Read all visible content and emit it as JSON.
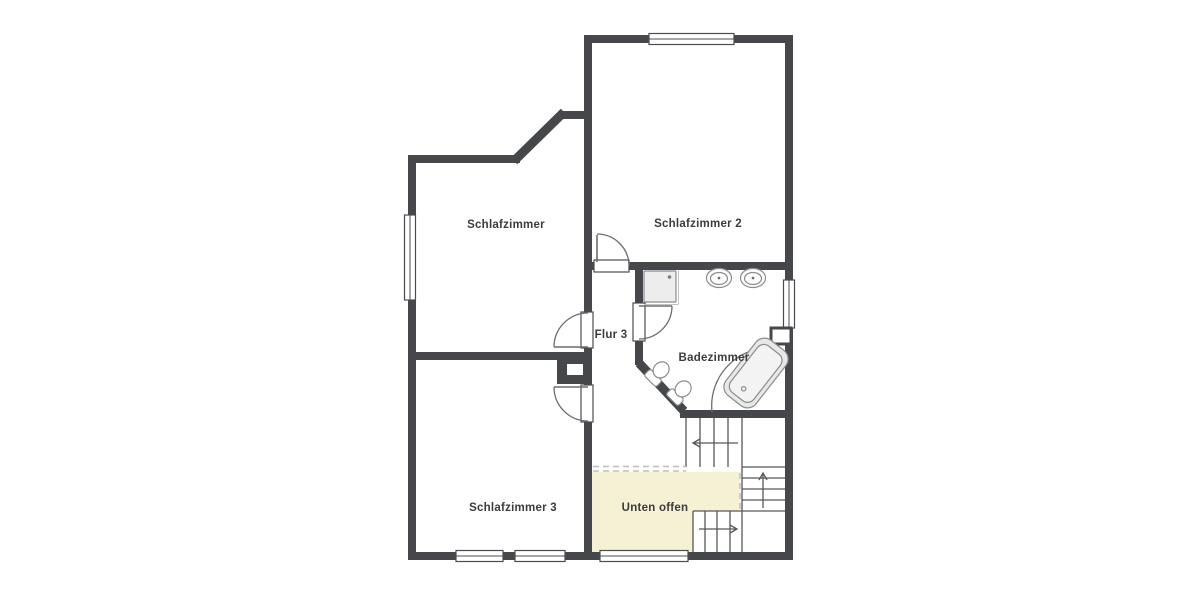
{
  "plan": {
    "type": "floor-plan",
    "rooms": {
      "schlafzimmer": {
        "label": "Schlafzimmer"
      },
      "schlafzimmer2": {
        "label": "Schlafzimmer 2"
      },
      "schlafzimmer3": {
        "label": "Schlafzimmer 3"
      },
      "flur3": {
        "label": "Flur 3"
      },
      "badezimmer": {
        "label": "Badezimmer"
      },
      "unten_offen": {
        "label": "Unten offen"
      }
    },
    "fixtures": [
      "shower",
      "sink",
      "sink",
      "toilet",
      "toilet",
      "bathtub"
    ],
    "stairs": {
      "arrow_directions": [
        "left",
        "up",
        "right"
      ]
    },
    "colors": {
      "wall": "#45474a",
      "void_area": "#f5f1d4",
      "label": "#3c3c3c",
      "stair_line": "#55575a",
      "fixture_stroke": "#8a8c8e",
      "dashed": "#bdbdbd",
      "shower_fill": "#ededed",
      "tub_fill": "#e8e8e8",
      "background": "#ffffff"
    }
  }
}
